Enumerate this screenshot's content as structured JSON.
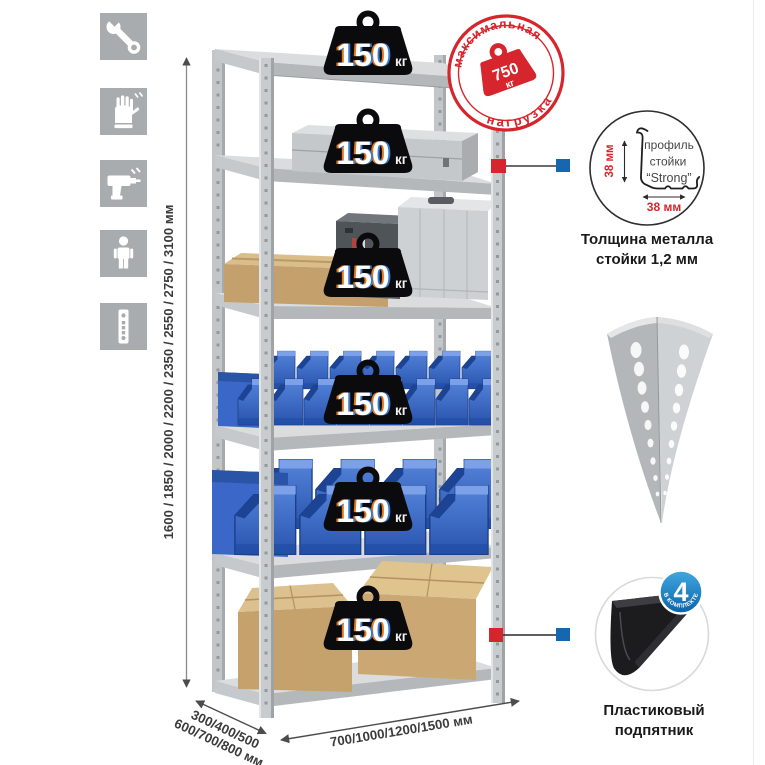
{
  "colors": {
    "accent_red": "#d6252c",
    "accent_blue": "#1568b0",
    "bin_blue": "#2e5fc4",
    "metal_gray": "#c7cacc",
    "icon_bg": "#a8acaf"
  },
  "sidebar": {
    "icons": [
      "wrench-icon",
      "gloves-icon",
      "drill-icon",
      "person-icon",
      "upright-profile-icon"
    ]
  },
  "dimensions": {
    "height_label": "1600 / 1850 / 2000 / 2200 / 2350 / 2550 / 2750 / 3100 мм",
    "depth_line1": "300/400/500",
    "depth_line2": "600/700/800 мм",
    "width_label": "700/1000/1200/1500 мм"
  },
  "rack": {
    "loads": [
      {
        "value": "150",
        "unit": "кг"
      },
      {
        "value": "150",
        "unit": "кг"
      },
      {
        "value": "150",
        "unit": "кг"
      },
      {
        "value": "150",
        "unit": "кг"
      },
      {
        "value": "150",
        "unit": "кг"
      },
      {
        "value": "150",
        "unit": "кг"
      }
    ]
  },
  "stamp": {
    "arc_top": "максимальная",
    "arc_bottom": "нагрузка",
    "value": "750",
    "unit": "кг"
  },
  "profile": {
    "dim_vertical": "38 мм",
    "dim_horizontal": "38 мм",
    "line1": "профиль",
    "line2": "стойки",
    "line3": "“Strong”",
    "caption_line1": "Толщина металла",
    "caption_line2": "стойки 1,2 мм"
  },
  "foot": {
    "badge_value": "4",
    "badge_arc": "В КОМПЛЕКТЕ",
    "caption_line1": "Пластиковый",
    "caption_line2": "подпятник"
  }
}
